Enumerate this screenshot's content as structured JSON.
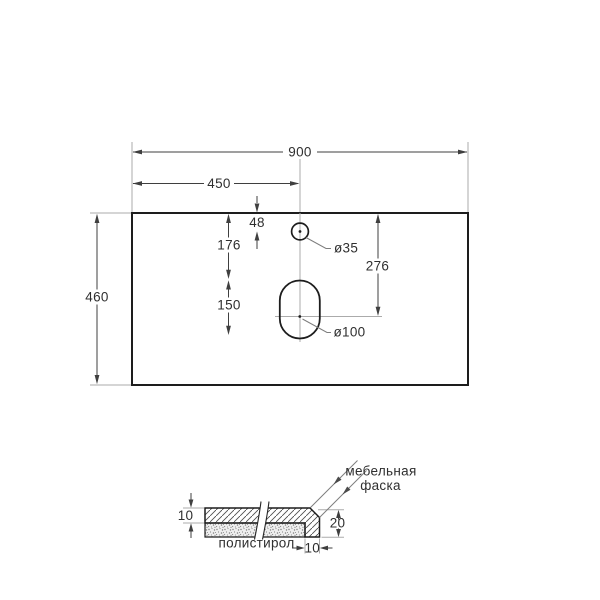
{
  "top_view": {
    "width": "900",
    "half_width": "450",
    "faucet_offset_from_edge": "48",
    "edge_to_drain_top": "176",
    "drain_slot_height": "150",
    "depth": "460",
    "edge_to_drain_center": "276",
    "faucet_hole": "ø35",
    "drain_hole": "ø100"
  },
  "section_view": {
    "top_layer_thickness": "10",
    "edge_height": "20",
    "edge_width": "10",
    "polystyrene_label": "полистирол",
    "chamfer_label_line1": "мебельная",
    "chamfer_label_line2": "фаска"
  },
  "colors": {
    "outline": "#1d1d1d",
    "dimension": "#3f3f3f",
    "extension": "#ababab",
    "leader": "#7d7d7d",
    "text": "#2f2f2f",
    "background": "#ffffff"
  }
}
